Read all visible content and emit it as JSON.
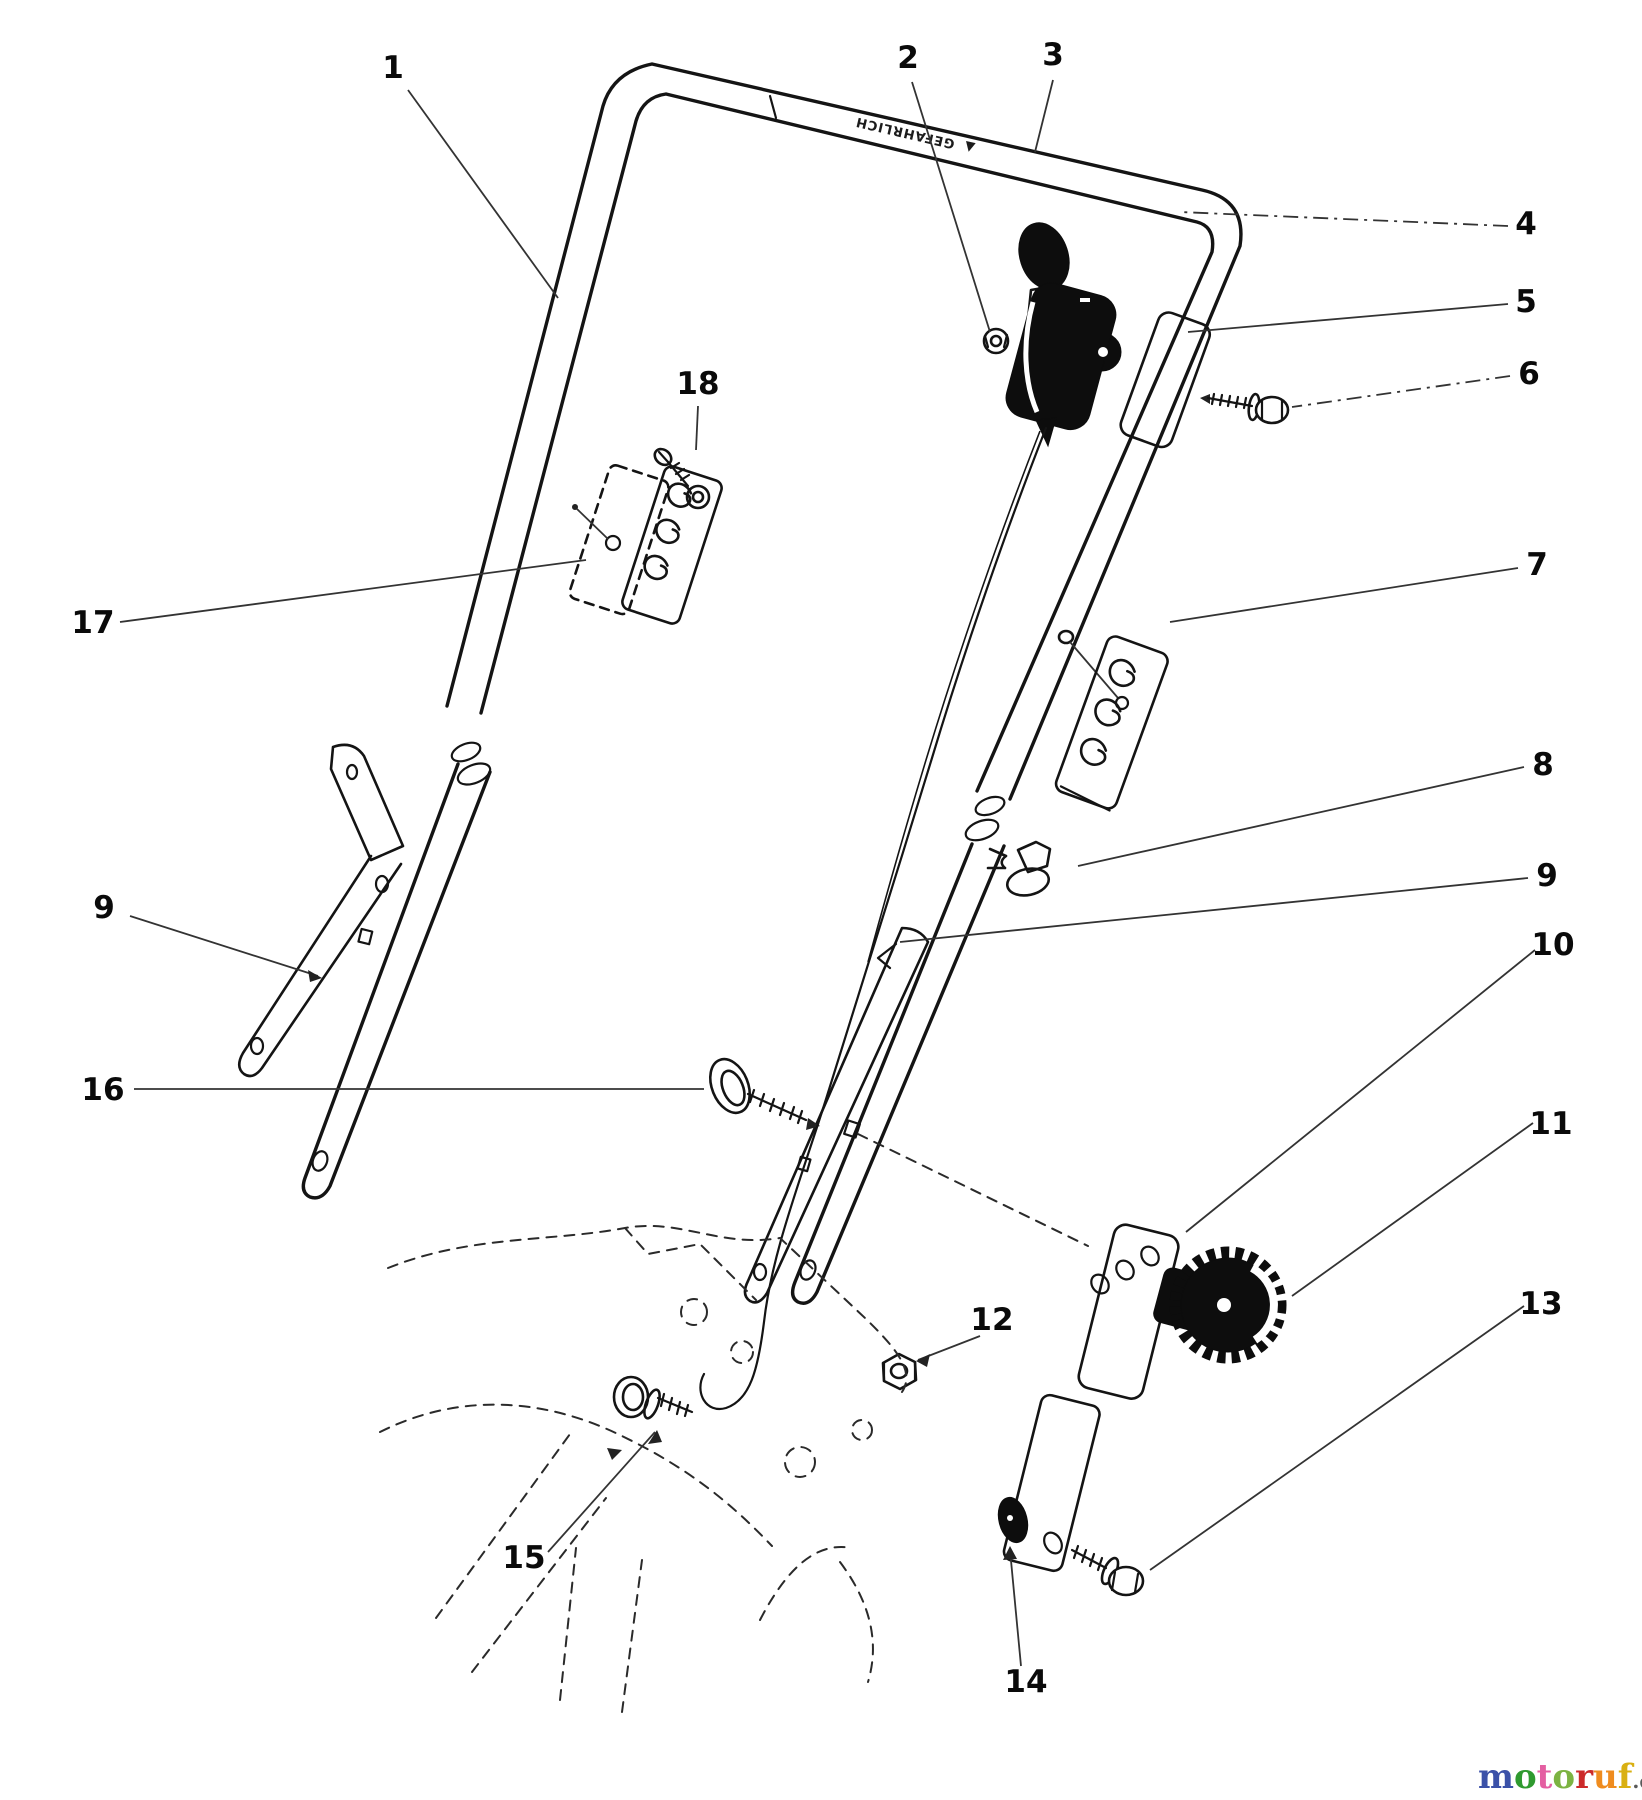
{
  "warning": {
    "triangle": "▲",
    "text": "GEFAHRLICH"
  },
  "callouts": {
    "c1": "1",
    "c2": "2",
    "c3": "3",
    "c4": "4",
    "c5": "5",
    "c6": "6",
    "c7": "7",
    "c8": "8",
    "c9_right": "9",
    "c9_left": "9",
    "c10": "10",
    "c11": "11",
    "c12": "12",
    "c13": "13",
    "c14": "14",
    "c15": "15",
    "c16": "16",
    "c17": "17",
    "c18": "18"
  },
  "watermark": {
    "letters": [
      {
        "char": "m",
        "color": "#3b51a8"
      },
      {
        "char": "o",
        "color": "#2f9a2f"
      },
      {
        "char": "t",
        "color": "#e45fa2"
      },
      {
        "char": "o",
        "color": "#7cb342"
      },
      {
        "char": "r",
        "color": "#cc2a2a"
      },
      {
        "char": "u",
        "color": "#ef8c1f"
      },
      {
        "char": "f",
        "color": "#d9b012"
      }
    ],
    "suffix": ".de",
    "suffix_color": "#5a5a5a"
  }
}
